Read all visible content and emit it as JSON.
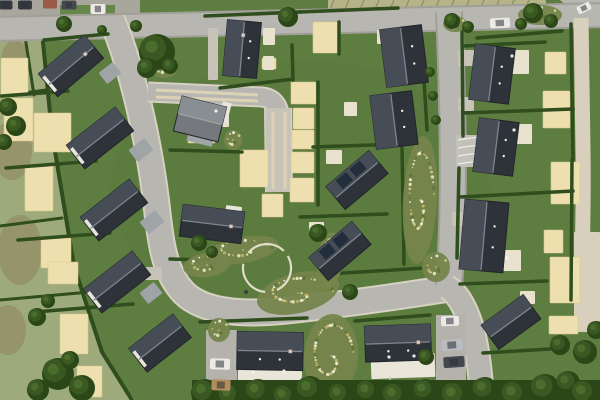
{
  "canvas": {
    "w": 600,
    "h": 400
  },
  "palette": {
    "lawn": "#5e7e41",
    "lawnDark": "#4a6631",
    "hedge": "#2f4d1d",
    "field": "#9dab7c",
    "fieldPatch": "#948e66",
    "fieldRows": "#b7b389",
    "rowLine": "#8a9464",
    "road": "#b7b6b0",
    "roadEdgeDark": "#a09f98",
    "roadEdgeLight": "#d6d1c1",
    "drive": "#c7c3b9",
    "track": "#dcd3b7",
    "path": "#d8d0bc",
    "pad": "#eedfae",
    "padEdge": "#d9c792",
    "patio": "#e7e1cd",
    "yard": "#a9a79d",
    "yardGreen": "#67874a",
    "roofDark": "#2e333a",
    "roofLight": "#464d56",
    "ridge": "#7e858e",
    "eave": "#20252a",
    "roofGray": "#75797d",
    "roofGrayLight": "#898e92",
    "ridgeGray": "#9da2a5",
    "garage": "#9fa4a6",
    "white": "#e9e6dd",
    "redRoof": "#9b5948",
    "panel": "#232e3c",
    "dot": "#f2f2ee",
    "treeDark": "#2b4717",
    "tree": "#3a5922",
    "treeLight": "#4d6e2d",
    "bedBase": "#75854c",
    "bedCols": [
      "#d8cf8e",
      "#ece5c0",
      "#f6f4ea",
      "#5d7636",
      "#c2b468"
    ],
    "fence": "#d6d2c6",
    "circleRing": "#e2ddc8",
    "carWhite": "#eceae6",
    "carSilver": "#b9bdc2",
    "carDark1": "#45484e",
    "carDark2": "#35383e",
    "carTan": "#b28d5e",
    "carWindow": "#2e3236"
  },
  "northStrip": {
    "fieldRows": [
      328,
      0,
      218,
      14
    ],
    "rowCount": 14
  },
  "yard": {
    "rect": [
      0,
      0,
      140,
      18
    ],
    "green": [
      60,
      5,
      55,
      11
    ]
  },
  "cornerPavement": "M560,0 L600,0 L600,28 L576,14 Z",
  "fields": {
    "poly": "M0,14 L40,30 L50,133 L72,266 L100,352 L135,400 L0,400 Z",
    "patches": [
      [
        12,
        150,
        20,
        30
      ],
      [
        20,
        250,
        22,
        35
      ],
      [
        8,
        330,
        18,
        25
      ],
      [
        15,
        60,
        14,
        20
      ]
    ],
    "hedgerows": [
      [
        0,
        96,
        46,
        90
      ],
      [
        0,
        226,
        62,
        218
      ],
      [
        0,
        300,
        90,
        292
      ],
      [
        24,
        30,
        34,
        95
      ]
    ],
    "boundary": "M42,32 L52,133 L74,266 L102,352 L132,400"
  },
  "roads": [
    {
      "d": "M-8,29 L608,15",
      "w": 22,
      "edge": "dark"
    },
    {
      "d": "M112,20 C130,62 147,130 156,200 C161,245 164,272 184,293 C206,314 248,315 292,310 C345,304 395,297 452,288",
      "w": 24,
      "edge": "light"
    },
    {
      "d": "M449,12 C452,80 454,160 452,230 C451,255 450,272 449,286",
      "w": 24,
      "edge": "dark"
    },
    {
      "d": "M447,287 C459,294 468,312 474,336 C479,358 481,378 482,404",
      "w": 22,
      "edge": "light"
    },
    {
      "d": "M148,92 L262,97 C272,98 278,104 279,114",
      "w": 17,
      "edge": "light"
    }
  ],
  "drive": {
    "d": "M278,108 L279,192",
    "w": 25,
    "tracks": [
      [
        273,
        112,
        273,
        189
      ],
      [
        285,
        112,
        285,
        189
      ],
      [
        156,
        90,
        258,
        95
      ],
      [
        156,
        97,
        258,
        101
      ]
    ]
  },
  "footpath": {
    "d": "M581,18 L583,150 C584,210 582,255 581,302",
    "w": 15
  },
  "pathPatch": [
    574,
    232,
    26,
    100
  ],
  "driveways": [
    [
      206,
      330,
      31,
      70
    ],
    [
      436,
      315,
      30,
      83
    ]
  ],
  "stubs": [
    [
      458,
      50,
      16,
      16
    ],
    [
      458,
      97,
      16,
      14
    ],
    [
      452,
      212,
      12,
      14
    ],
    [
      208,
      28,
      10,
      52
    ],
    [
      142,
      267,
      20,
      13
    ]
  ],
  "parking": {
    "rect": [
      456,
      135,
      24,
      32
    ],
    "lines": [
      [
        458,
        140,
        478,
        137
      ],
      [
        458,
        148,
        478,
        145
      ],
      [
        458,
        156,
        478,
        153
      ],
      [
        458,
        164,
        478,
        161
      ]
    ]
  },
  "pads": [
    [
      1,
      58,
      27,
      37
    ],
    [
      4,
      98,
      29,
      43
    ],
    [
      34,
      113,
      37,
      39
    ],
    [
      25,
      165,
      28,
      46
    ],
    [
      41,
      238,
      30,
      30
    ],
    [
      48,
      262,
      30,
      22
    ],
    [
      60,
      314,
      28,
      40
    ],
    [
      77,
      366,
      25,
      31
    ],
    [
      188,
      129,
      27,
      14
    ],
    [
      240,
      150,
      28,
      37
    ],
    [
      262,
      194,
      21,
      23
    ],
    [
      291,
      82,
      25,
      22
    ],
    [
      293,
      108,
      21,
      21
    ],
    [
      292,
      130,
      22,
      19
    ],
    [
      291,
      152,
      23,
      21
    ],
    [
      290,
      178,
      24,
      24
    ],
    [
      262,
      58,
      14,
      11
    ],
    [
      313,
      22,
      27,
      31
    ],
    [
      545,
      52,
      21,
      22
    ],
    [
      543,
      91,
      27,
      37
    ],
    [
      551,
      162,
      29,
      42
    ],
    [
      544,
      230,
      19,
      23
    ],
    [
      550,
      257,
      30,
      46
    ],
    [
      549,
      316,
      29,
      18
    ]
  ],
  "patios": [
    [
      263,
      28,
      12,
      17
    ],
    [
      263,
      56,
      11,
      14
    ],
    [
      213,
      106,
      16,
      21
    ],
    [
      377,
      30,
      9,
      14
    ],
    [
      344,
      102,
      13,
      14
    ],
    [
      326,
      150,
      16,
      14
    ],
    [
      309,
      222,
      15,
      12
    ],
    [
      507,
      50,
      22,
      24
    ],
    [
      512,
      124,
      20,
      20
    ],
    [
      502,
      250,
      19,
      21
    ],
    [
      520,
      291,
      15,
      13
    ]
  ],
  "hedges": [
    [
      2,
      96,
      68,
      91
    ],
    [
      6,
      168,
      96,
      161
    ],
    [
      18,
      240,
      110,
      233
    ],
    [
      35,
      312,
      133,
      304
    ],
    [
      44,
      40,
      108,
      34
    ],
    [
      205,
      16,
      300,
      12
    ],
    [
      300,
      12,
      398,
      8
    ],
    [
      477,
      38,
      562,
      31
    ],
    [
      292,
      45,
      293,
      80
    ],
    [
      220,
      88,
      293,
      79
    ],
    [
      318,
      82,
      318,
      205
    ],
    [
      170,
      150,
      242,
      152
    ],
    [
      170,
      259,
      235,
      261
    ],
    [
      313,
      147,
      400,
      144
    ],
    [
      300,
      217,
      387,
      214
    ],
    [
      295,
      276,
      425,
      268
    ],
    [
      402,
      148,
      404,
      264
    ],
    [
      465,
      46,
      545,
      42
    ],
    [
      463,
      113,
      573,
      109
    ],
    [
      460,
      197,
      573,
      191
    ],
    [
      460,
      284,
      547,
      281
    ],
    [
      483,
      353,
      550,
      349
    ],
    [
      200,
      322,
      307,
      318
    ],
    [
      355,
      321,
      430,
      315
    ],
    [
      571,
      24,
      573,
      160
    ],
    [
      572,
      160,
      571,
      300
    ],
    [
      462,
      30,
      463,
      136
    ],
    [
      459,
      168,
      457,
      258
    ],
    [
      339,
      22,
      339,
      54
    ],
    [
      422,
      45,
      427,
      130
    ]
  ],
  "beds": [
    [
      207,
      265,
      24,
      12,
      -8
    ],
    [
      243,
      250,
      36,
      13,
      -10
    ],
    [
      298,
      293,
      42,
      20,
      -14
    ],
    [
      330,
      260,
      13,
      28,
      6
    ],
    [
      420,
      200,
      17,
      64,
      3
    ],
    [
      331,
      356,
      27,
      42,
      4
    ],
    [
      219,
      330,
      11,
      12,
      0
    ],
    [
      436,
      267,
      14,
      15,
      0
    ],
    [
      233,
      140,
      9,
      10,
      0
    ],
    [
      540,
      15,
      22,
      10,
      0
    ],
    [
      455,
      24,
      12,
      8,
      0
    ],
    [
      164,
      68,
      14,
      10,
      0
    ]
  ],
  "circleFeature": {
    "cx": 267,
    "cy": 268,
    "r": 24
  },
  "outbuildings": [
    [
      110,
      73,
      18,
      14,
      -38,
      "garage"
    ],
    [
      141,
      150,
      20,
      15,
      -38,
      "garage"
    ],
    [
      152,
      222,
      20,
      15,
      -38,
      "garage"
    ],
    [
      151,
      293,
      18,
      14,
      -38,
      "garage"
    ],
    [
      201,
      136,
      26,
      16,
      14,
      "garage"
    ],
    [
      225,
      112,
      9,
      20,
      14,
      "white"
    ],
    [
      233,
      215,
      16,
      18,
      7,
      "white"
    ],
    [
      50,
      4,
      14,
      9,
      0,
      "red"
    ]
  ],
  "terraces": [
    [
      270,
      371,
      64,
      20,
      1
    ],
    [
      403,
      366,
      64,
      24,
      -2
    ]
  ],
  "houses": [
    {
      "cx": 71,
      "cy": 66,
      "w": 60,
      "h": 30,
      "rot": -40,
      "gable": "w",
      "chimney": true
    },
    {
      "cx": 100,
      "cy": 138,
      "w": 62,
      "h": 30,
      "rot": -38,
      "gable": "w"
    },
    {
      "cx": 114,
      "cy": 210,
      "w": 62,
      "h": 30,
      "rot": -38,
      "gable": "w"
    },
    {
      "cx": 117,
      "cy": 282,
      "w": 62,
      "h": 30,
      "rot": -38,
      "gable": "w"
    },
    {
      "cx": 160,
      "cy": 343,
      "w": 56,
      "h": 30,
      "rot": -38,
      "gable": "w"
    },
    {
      "cx": 242,
      "cy": 49,
      "w": 34,
      "h": 56,
      "rot": 5,
      "dots": true,
      "chimney": true
    },
    {
      "cx": 200,
      "cy": 119,
      "w": 46,
      "h": 36,
      "rot": 14,
      "roof": "gray"
    },
    {
      "cx": 212,
      "cy": 224,
      "w": 62,
      "h": 32,
      "rot": 7,
      "chimney": true
    },
    {
      "cx": 404,
      "cy": 56,
      "w": 42,
      "h": 58,
      "rot": -7,
      "dots": true
    },
    {
      "cx": 394,
      "cy": 120,
      "w": 42,
      "h": 54,
      "rot": -7,
      "dots": true
    },
    {
      "cx": 357,
      "cy": 180,
      "w": 56,
      "h": 30,
      "rot": -40,
      "panels": true
    },
    {
      "cx": 340,
      "cy": 251,
      "w": 56,
      "h": 30,
      "rot": -40,
      "panels": true
    },
    {
      "cx": 492,
      "cy": 74,
      "w": 40,
      "h": 56,
      "rot": 7,
      "dots": true
    },
    {
      "cx": 496,
      "cy": 147,
      "w": 40,
      "h": 54,
      "rot": 7,
      "dots": true
    },
    {
      "cx": 484,
      "cy": 236,
      "w": 44,
      "h": 70,
      "rot": 5,
      "dots": true
    },
    {
      "cx": 511,
      "cy": 322,
      "w": 52,
      "h": 30,
      "rot": -36
    },
    {
      "cx": 270,
      "cy": 351,
      "w": 66,
      "h": 38,
      "rot": 1,
      "chimney": true,
      "dots": true
    },
    {
      "cx": 398,
      "cy": 343,
      "w": 66,
      "h": 36,
      "rot": -2,
      "chimney": true,
      "dots": true
    }
  ],
  "fences": [
    [
      232,
      382,
      232,
      400
    ],
    [
      268,
      382,
      268,
      400
    ],
    [
      306,
      380,
      306,
      400
    ],
    [
      390,
      376,
      390,
      400
    ]
  ],
  "treeBand": [
    192,
    380,
    408,
    20
  ],
  "trees": [
    [
      157,
      52,
      18
    ],
    [
      147,
      68,
      10
    ],
    [
      64,
      24,
      8
    ],
    [
      136,
      26,
      6
    ],
    [
      102,
      30,
      5
    ],
    [
      533,
      13,
      10
    ],
    [
      551,
      21,
      7
    ],
    [
      521,
      24,
      6
    ],
    [
      452,
      21,
      8
    ],
    [
      468,
      27,
      6
    ],
    [
      288,
      17,
      10
    ],
    [
      430,
      72,
      5
    ],
    [
      433,
      96,
      5
    ],
    [
      436,
      120,
      5
    ],
    [
      199,
      243,
      8
    ],
    [
      212,
      252,
      6
    ],
    [
      318,
      233,
      9
    ],
    [
      350,
      292,
      8
    ],
    [
      170,
      66,
      8
    ],
    [
      8,
      107,
      9
    ],
    [
      16,
      126,
      10
    ],
    [
      4,
      142,
      8
    ],
    [
      37,
      317,
      9
    ],
    [
      48,
      301,
      7
    ],
    [
      58,
      374,
      16
    ],
    [
      82,
      388,
      13
    ],
    [
      38,
      390,
      11
    ],
    [
      70,
      360,
      9
    ],
    [
      426,
      357,
      8
    ],
    [
      205,
      393,
      14
    ],
    [
      230,
      396,
      12
    ],
    [
      258,
      392,
      13
    ],
    [
      285,
      397,
      12
    ],
    [
      310,
      390,
      14
    ],
    [
      340,
      395,
      12
    ],
    [
      368,
      392,
      12
    ],
    [
      395,
      396,
      13
    ],
    [
      425,
      391,
      12
    ],
    [
      455,
      396,
      14
    ],
    [
      485,
      390,
      13
    ],
    [
      515,
      395,
      14
    ],
    [
      545,
      389,
      15
    ],
    [
      568,
      383,
      12
    ],
    [
      585,
      394,
      14
    ],
    [
      560,
      345,
      10
    ],
    [
      585,
      352,
      12
    ],
    [
      596,
      330,
      9
    ]
  ],
  "vehicles": [
    [
      25,
      5,
      14,
      9,
      0,
      "carDark2"
    ],
    [
      69,
      5,
      15,
      9,
      0,
      "carDark1"
    ],
    [
      98,
      9,
      15,
      10,
      0,
      "carWhite"
    ],
    [
      6,
      5,
      13,
      9,
      0,
      "carDark2"
    ],
    [
      500,
      23,
      20,
      10,
      -3,
      "carWhite"
    ],
    [
      584,
      8,
      14,
      8,
      -25,
      "carWhite"
    ],
    [
      220,
      364,
      20,
      11,
      2,
      "carWhite"
    ],
    [
      221,
      385,
      19,
      11,
      2,
      "carTan"
    ],
    [
      450,
      321,
      18,
      10,
      -2,
      "carWhite"
    ],
    [
      452,
      345,
      21,
      11,
      -4,
      "carSilver"
    ],
    [
      454,
      362,
      21,
      11,
      -4,
      "carDark1"
    ]
  ],
  "specks": [
    [
      253,
      372
    ],
    [
      284,
      371
    ],
    [
      216,
      111
    ],
    [
      512,
      56
    ],
    [
      514,
      130
    ],
    [
      507,
      258
    ],
    [
      389,
      357
    ],
    [
      414,
      356
    ]
  ]
}
